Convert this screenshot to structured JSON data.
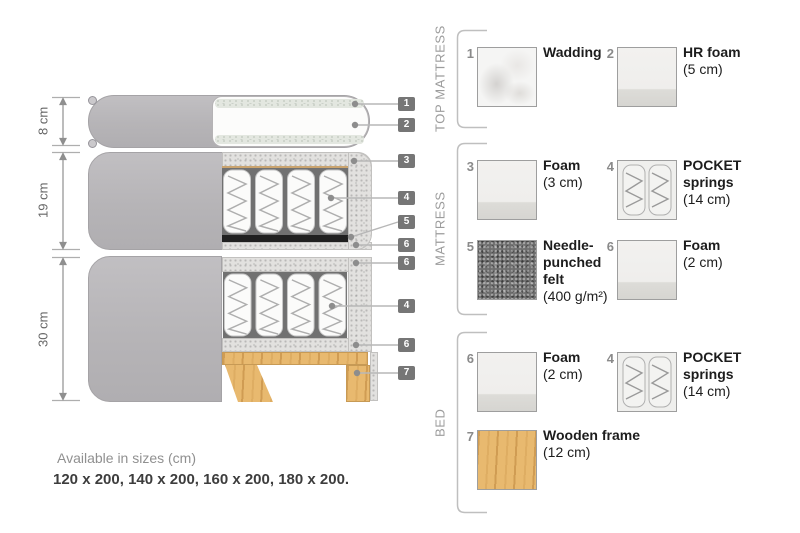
{
  "diagram": {
    "dimensions": [
      {
        "label": "8 cm"
      },
      {
        "label": "19 cm"
      },
      {
        "label": "30 cm"
      }
    ],
    "callouts": [
      {
        "number": "1"
      },
      {
        "number": "2"
      },
      {
        "number": "3"
      },
      {
        "number": "4"
      },
      {
        "number": "5"
      },
      {
        "number": "6"
      },
      {
        "number": "6"
      },
      {
        "number": "4"
      },
      {
        "number": "6"
      },
      {
        "number": "7"
      }
    ],
    "footer": {
      "available_title": "Available in sizes (cm)",
      "available_sizes": "120 x 200, 140 x 200, 160 x 200, 180 x 200."
    }
  },
  "legend": {
    "sections": [
      {
        "label": "TOP MATTRESS",
        "items": [
          {
            "num": "1",
            "name": "Wadding",
            "size": "",
            "texture": "wadding"
          },
          {
            "num": "2",
            "name": "HR foam",
            "size": "(5 cm)",
            "texture": "foam"
          }
        ]
      },
      {
        "label": "MATTRESS",
        "items": [
          {
            "num": "3",
            "name": "Foam",
            "size": "(3 cm)",
            "texture": "foam"
          },
          {
            "num": "4",
            "name": "POCKET springs",
            "size": "(14 cm)",
            "texture": "pocket-springs"
          },
          {
            "num": "5",
            "name": "Needle-punched felt",
            "size": "(400 g/m²)",
            "texture": "felt"
          },
          {
            "num": "6",
            "name": "Foam",
            "size": "(2 cm)",
            "texture": "foam"
          }
        ]
      },
      {
        "label": "BED",
        "items": [
          {
            "num": "6",
            "name": "Foam",
            "size": "(2 cm)",
            "texture": "foam"
          },
          {
            "num": "4",
            "name": "POCKET springs",
            "size": "(14 cm)",
            "texture": "pocket-springs"
          },
          {
            "num": "7",
            "name": "Wooden frame",
            "size": "(12 cm)",
            "texture": "wood"
          }
        ]
      }
    ]
  },
  "colors": {
    "cover_gray": "#b7b5b8",
    "foam_speckle": "#e2e1df",
    "wood": "#e8b96f",
    "felt": "#6d6d6d",
    "tag_background": "#767676",
    "leader_line": "#b7b7b7",
    "text_dark": "#1d1d1d",
    "text_gray": "#9c9c9c"
  }
}
